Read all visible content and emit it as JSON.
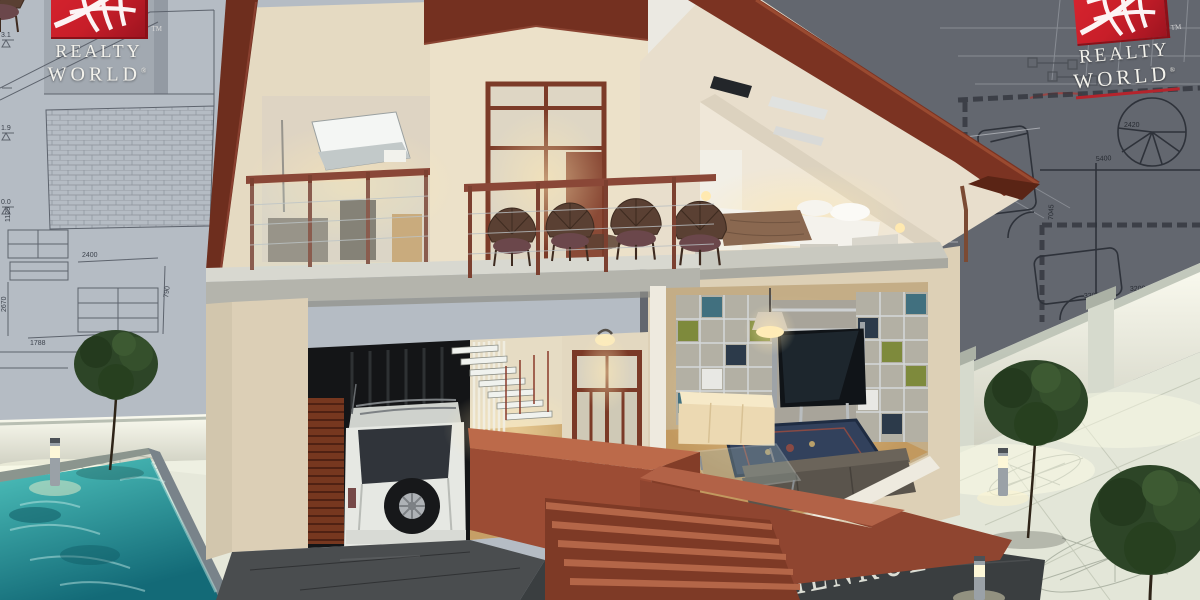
{
  "branding": {
    "logo_text_line1": "REALTY",
    "logo_text_line2": "WORLD",
    "trademark_symbol": "TM",
    "registered_symbol": "®",
    "globe_icon": "globe-icon"
  },
  "watermark": {
    "text": "RİMENKUL"
  },
  "blueprint": {
    "elevation_marks": {
      "m1": "3.1",
      "m2": "1.9",
      "m3": "0.0"
    },
    "left_dims": {
      "w1125": "1125",
      "w2670": "2670",
      "w1788": "1788",
      "w2400": "2400",
      "w790": "790"
    },
    "right_dims": {
      "d2420": "2420",
      "d5400": "5400",
      "d7045": "7045",
      "d3300": "3300",
      "d3200": "3200"
    }
  },
  "palette": {
    "logo_red": "#c81e29",
    "roof_brown": "#7b3322",
    "wall_cream": "#e8ddc6",
    "terracotta": "#9c4c34",
    "pool_teal": "#2f9fa0",
    "blueprint_light": "#b5bcc4",
    "blueprint_dark": "#63676f",
    "foliage_green": "#314828"
  }
}
